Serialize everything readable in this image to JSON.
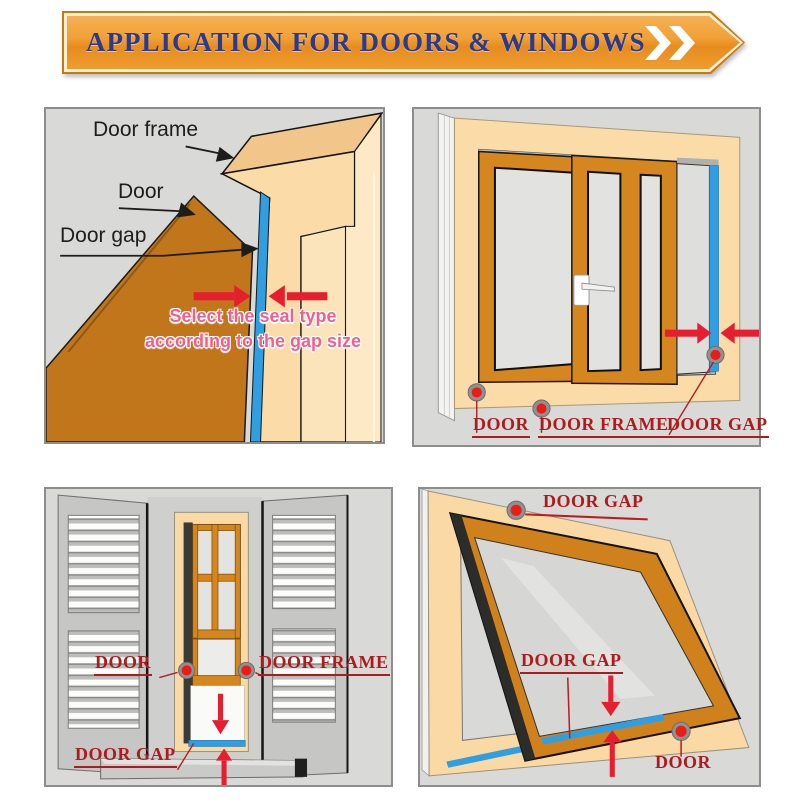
{
  "header": {
    "title": "APPLICATION FOR DOORS & WINDOWS",
    "chevron_icon": "double-chevron-right",
    "colors": {
      "banner": "#EF9D2F",
      "banner_border": "#C8790F",
      "title": "#2B3A8D"
    }
  },
  "panel_door_corner": {
    "label_door_frame": "Door frame",
    "label_door": "Door",
    "label_door_gap": "Door gap",
    "note_line1": "Select the seal type",
    "note_line2": "according to the gap size"
  },
  "panel_sliding_door": {
    "label_door": "DOOR",
    "label_door_frame": "DOOR FRAME",
    "label_door_gap": "DOOR GAP"
  },
  "panel_sash_window": {
    "label_door": "DOOR",
    "label_door_frame": "DOOR FRAME",
    "label_door_gap": "DOOR GAP"
  },
  "panel_awning_window": {
    "label_door_gap_top": "DOOR GAP",
    "label_door_gap_mid": "DOOR GAP",
    "label_door": "DOOR"
  },
  "colors": {
    "seal_blue": "#2F9EE2",
    "door_orange": "#C1761C",
    "frame_peach": "#FBD9A4",
    "sash_orange": "#D6861E",
    "label_red": "#AE1B1F",
    "arrow_red": "#E51F30",
    "note_pink": "#F0608C",
    "panel_bg": "#D9D9D7"
  }
}
